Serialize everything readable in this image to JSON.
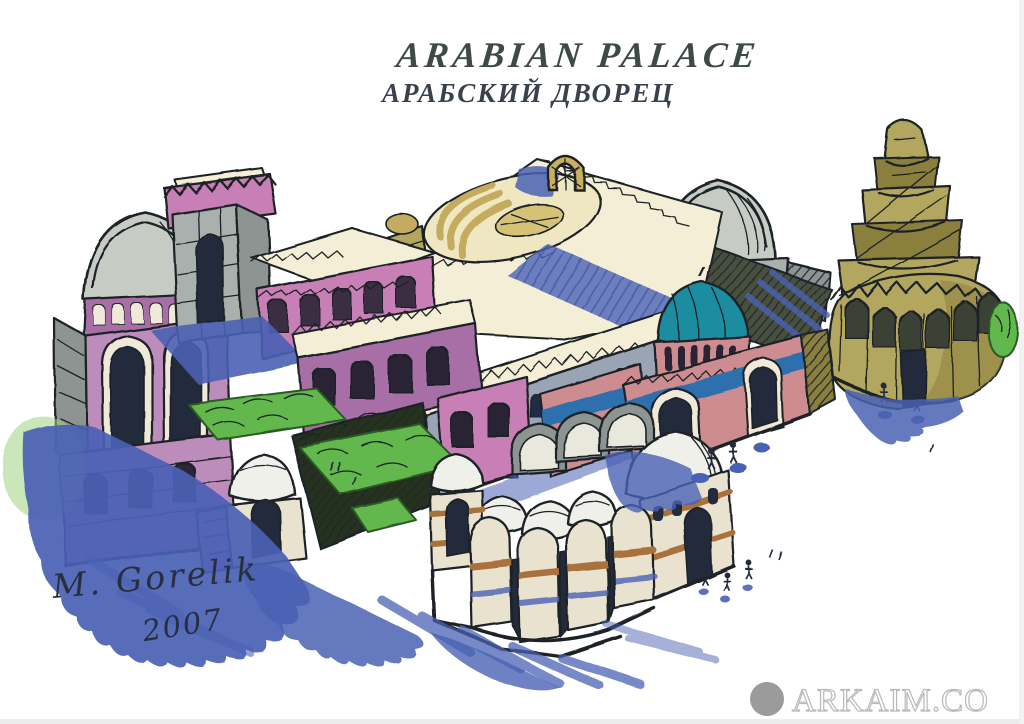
{
  "artwork": {
    "title": "ARABIAN PALACE",
    "subtitle": "АРАБСКИЙ ДВОРЕЦ",
    "signature": "M. Gorelik",
    "year": "2007"
  },
  "watermark": {
    "text": "Arkaim.co"
  },
  "scene": {
    "description": "Hand-drawn ink and marker concept sketch of an Arabian palace complex in aerial isometric view: gray domes, a crenellated stone tower, purple and pink arcaded walls, a large cream roof with a sunken oval courtyard, a teal-domed pink gatehouse, a bathhouse cluster of small domes with striped walls, a round arcaded gallery topped by a Samarra-style spiral minaret, green garden terraces, tiny sketched people and sweeping blue marker shadows on white paper."
  },
  "palette": {
    "paper": "#ffffff",
    "ink": "#1c2126",
    "title_ink": "#3e4a44",
    "subtitle_ink": "#39424c",
    "signature_ink": "#272e3f",
    "blue_shadow": "#4a61b4",
    "blue_light": "#8093cf",
    "blue_band": "#2f6fae",
    "purple": "#a86ea6",
    "purple_light": "#bc8cba",
    "pink": "#c87fb5",
    "salmon": "#cd8d90",
    "teal": "#1b8da1",
    "olive": "#b3a75e",
    "olive_dark": "#8a7f3e",
    "cream": "#f5eed6",
    "tan": "#c4ab5e",
    "stone": "#a9b0ad",
    "stone_dark": "#8d9492",
    "gray_dome": "#c6ccc4",
    "green": "#63b84d",
    "green_soft": "#9ed47f",
    "green_dark": "#2c5a26",
    "dark": "#232a3a",
    "brown": "#a9713d",
    "wall_cream": "#e8e2cf",
    "watermark_gray": "#9b9b9b"
  }
}
